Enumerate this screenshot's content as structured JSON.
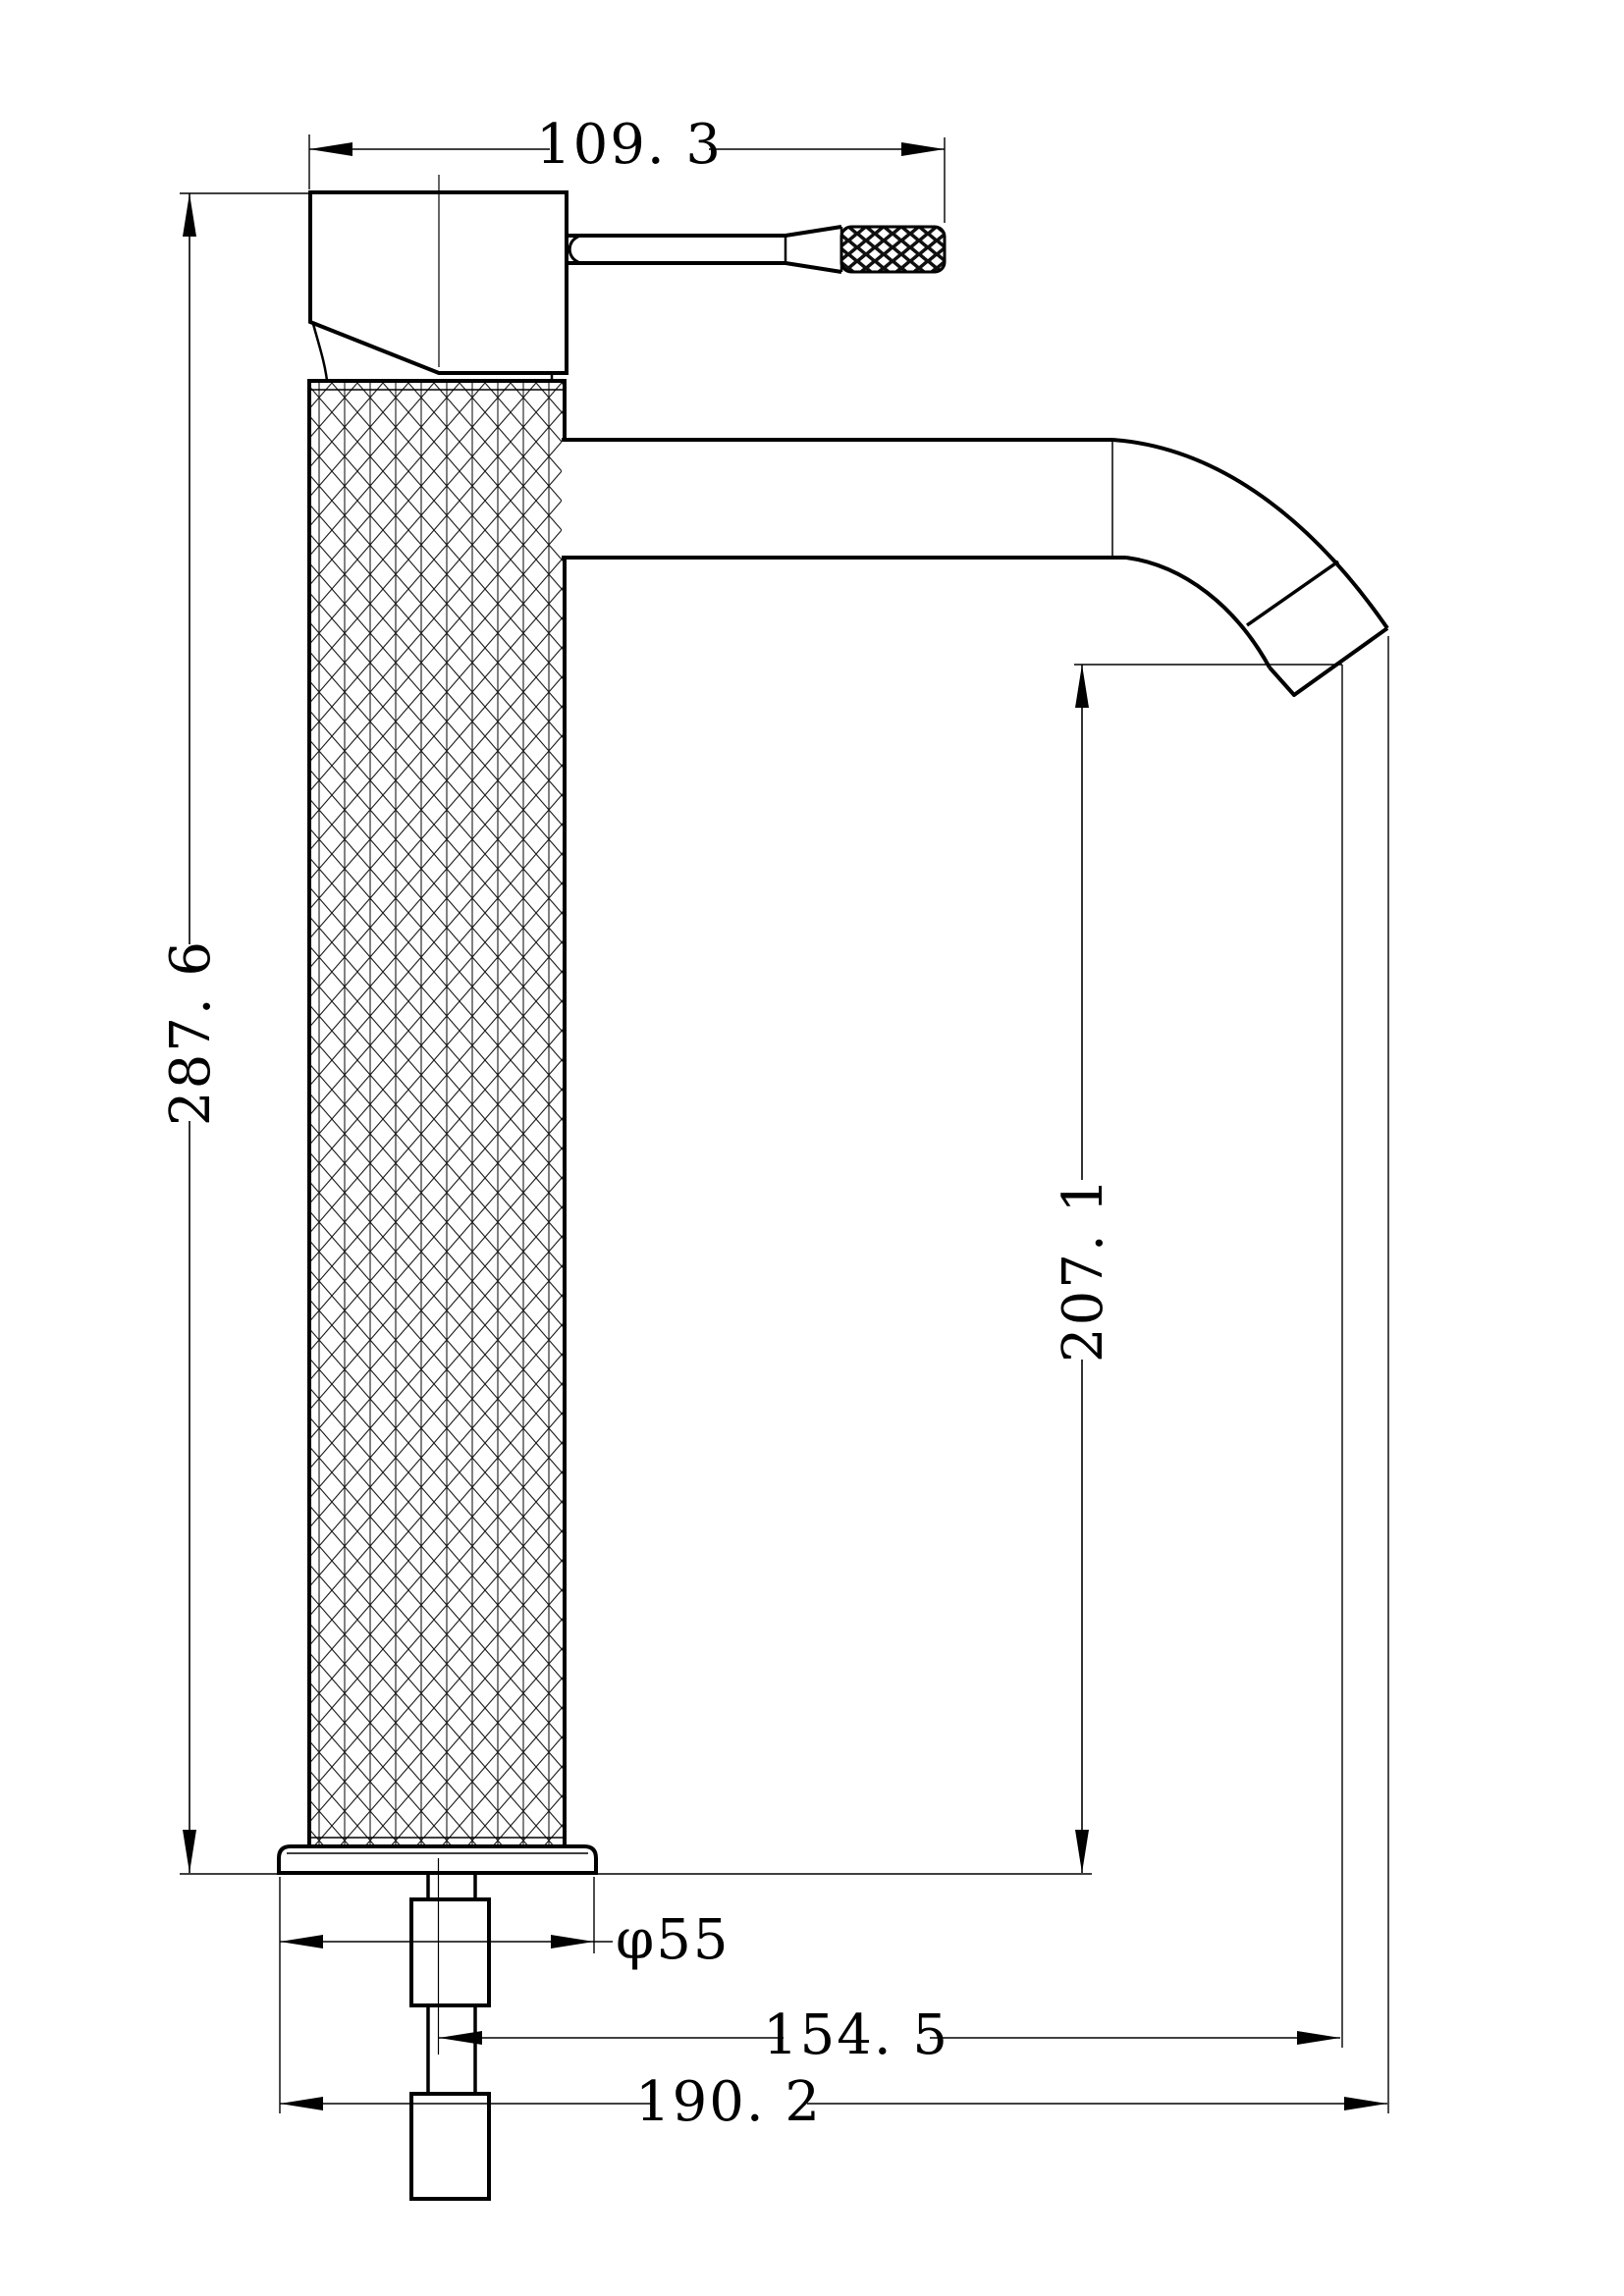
{
  "drawing": {
    "type": "technical-dimension-drawing",
    "subject": "tall single-lever knurled basin mixer tap, side elevation",
    "units": "mm",
    "background_color": "#ffffff",
    "line_color": "#000000",
    "dimensions": {
      "handle_reach": "109. 3",
      "overall_height": "287. 6",
      "spout_outlet_height": "207. 1",
      "base_diameter": "φ55",
      "spout_reach_from_center": "154. 5",
      "overall_reach": "190. 2"
    }
  }
}
